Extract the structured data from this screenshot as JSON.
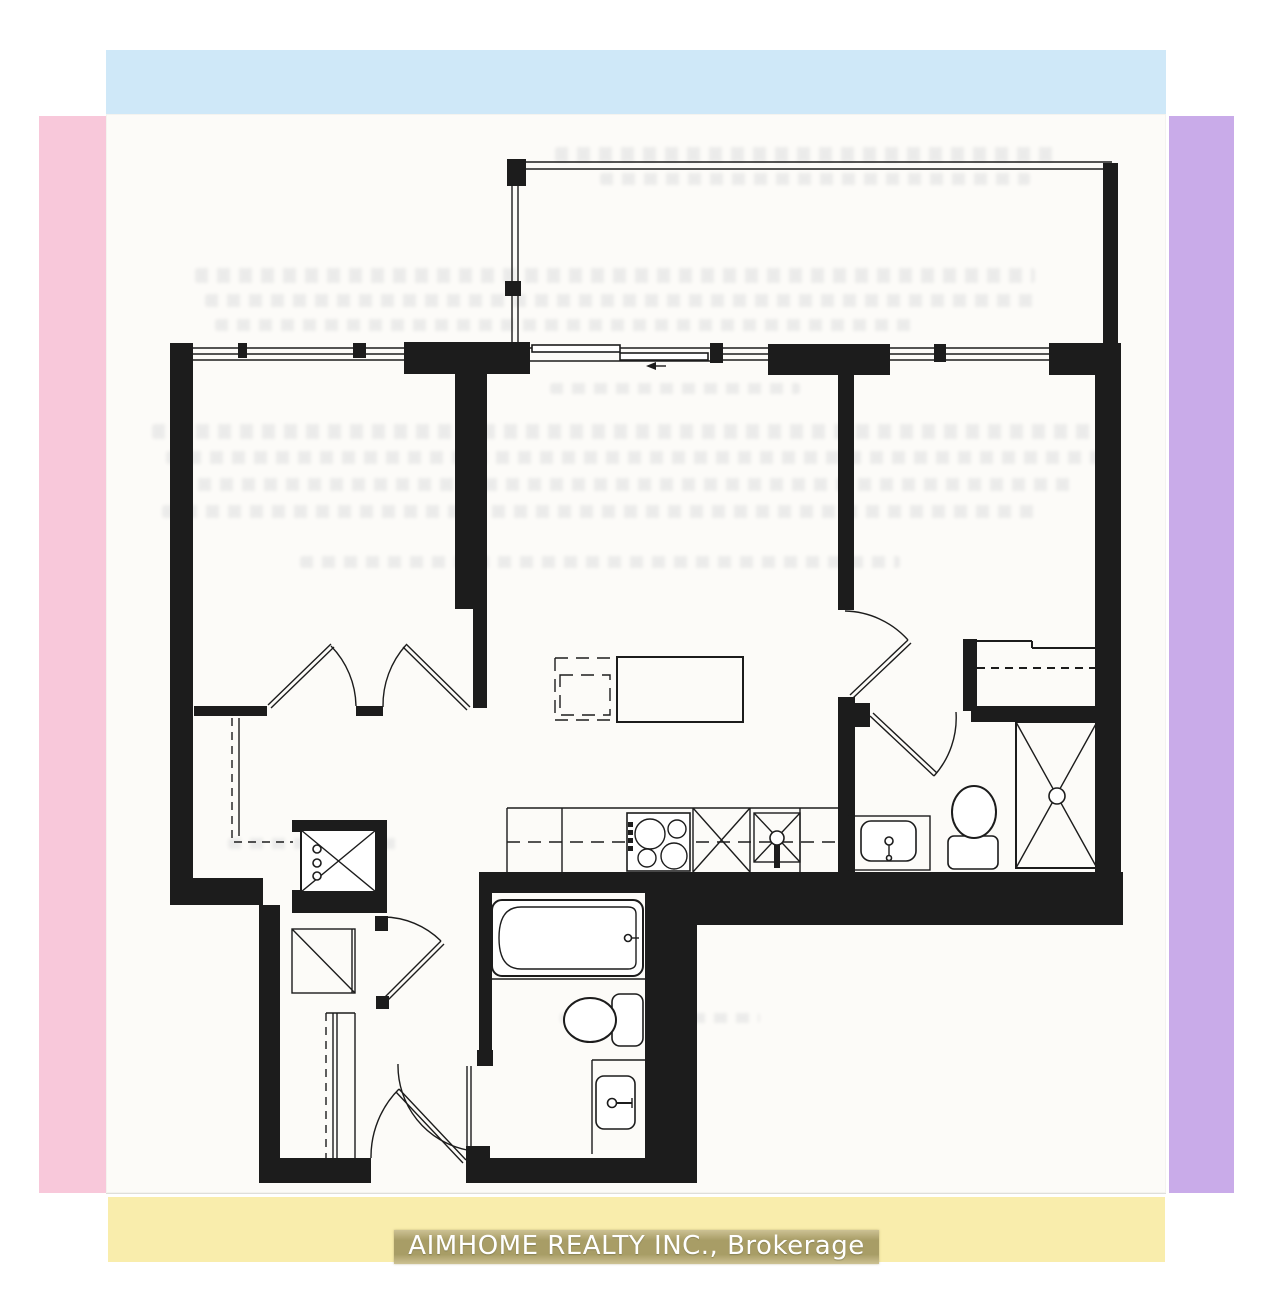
{
  "colors": {
    "top-bar": "#cfe8f8",
    "left-bar": "#f8c8da",
    "right-bar": "#c9abe9",
    "bottom-bar": "#f9edac",
    "brand-highlight": "#a89d66",
    "brand-text": "#ffffff",
    "ink": "#1c1c1c",
    "paper": "#fcfbf8"
  },
  "footer": {
    "brand": "AIMHOME REALTY INC., Brokerage"
  },
  "floorplan": {
    "type": "residential-condo-unit-floor-plan",
    "rooms": [
      "balcony",
      "bedroom-1",
      "bedroom-2",
      "living-dining-kitchen",
      "bathroom-main",
      "bathroom-second",
      "laundry-closet",
      "entry-foyer"
    ],
    "fixtures": [
      "bathtub",
      "toilet",
      "toilet",
      "vanity-sink",
      "vanity-sink",
      "shower-stall",
      "washer-dryer",
      "cooktop",
      "kitchen-sink",
      "dishwasher",
      "kitchen-island",
      "sliding-balcony-door",
      "closet-double-doors",
      "entry-door"
    ]
  }
}
